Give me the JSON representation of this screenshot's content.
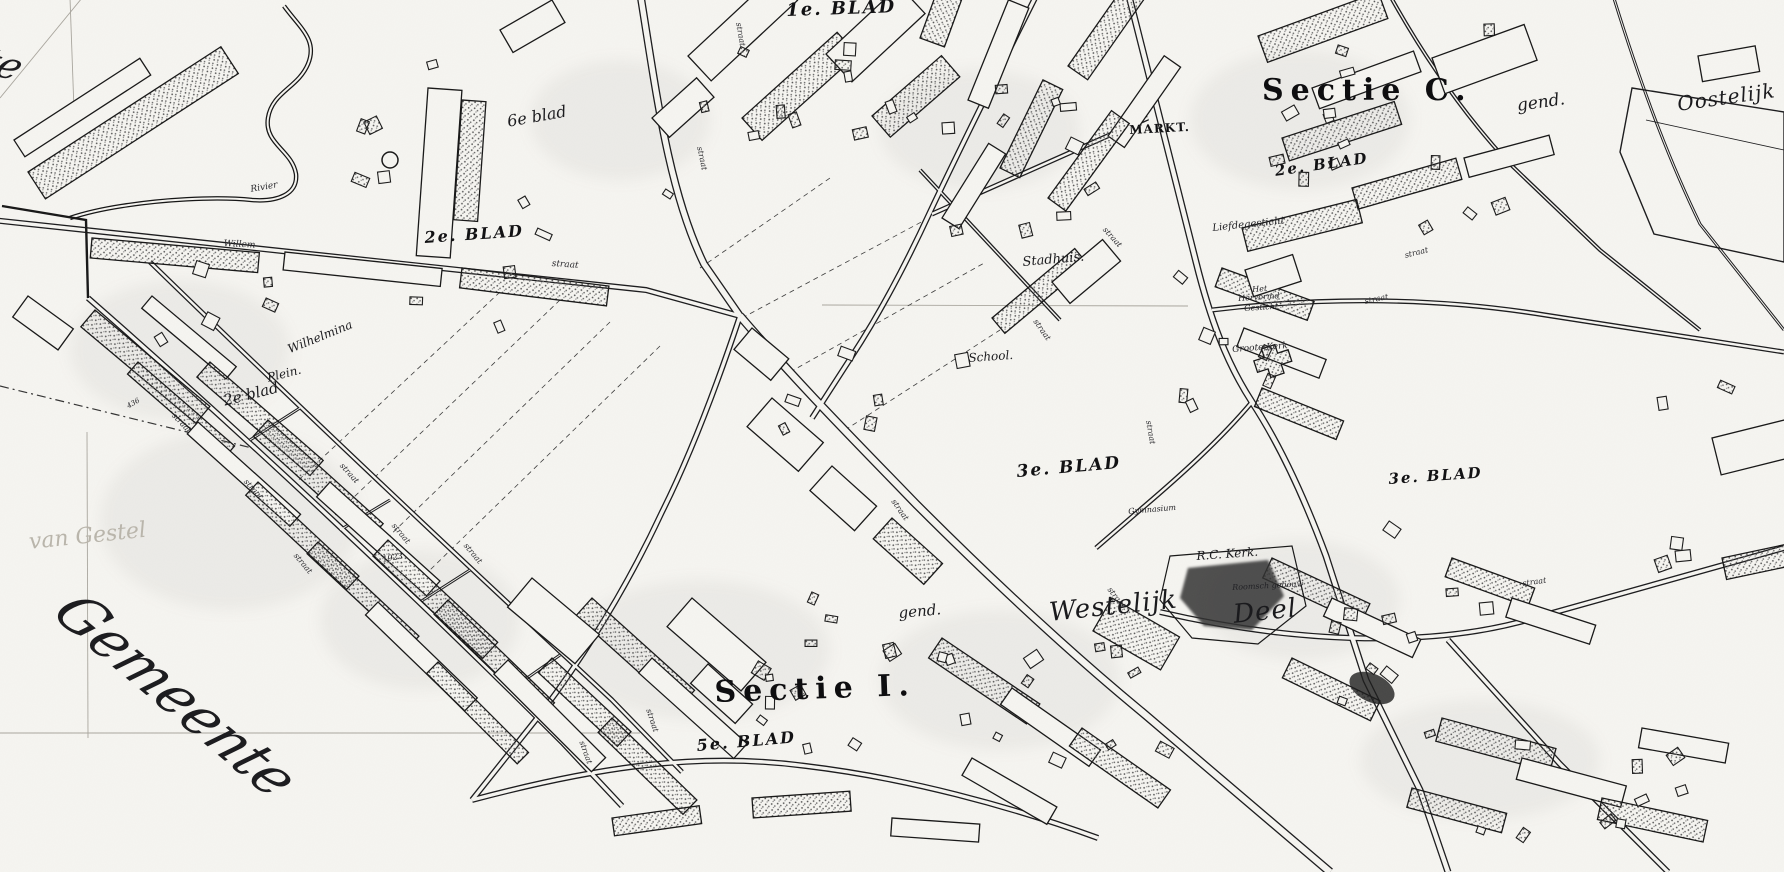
{
  "map": {
    "name": "historic-cadastral-town-map",
    "colors": {
      "ink": "#1a1a1c",
      "paper": "#f6f5f1",
      "smudge": "#777777",
      "faint_line": "#a9a69e"
    },
    "labels": [
      {
        "id": "sheet-1-blad",
        "text": "1e. BLAD",
        "x": 786,
        "y": 2,
        "rot": -2,
        "size": 18,
        "cls": "bold"
      },
      {
        "id": "sheet-6-blad-cursive",
        "text": "6e blad",
        "x": 506,
        "y": 114,
        "rot": -10,
        "size": 16,
        "cls": "cursive"
      },
      {
        "id": "sheet-2-blad-left",
        "text": "2e. BLAD",
        "x": 424,
        "y": 230,
        "rot": -4,
        "size": 16,
        "cls": "bold"
      },
      {
        "id": "section-c-title",
        "text": "Sectie C.",
        "x": 1262,
        "y": 76,
        "rot": 0,
        "size": 30,
        "cls": "sectie"
      },
      {
        "id": "markt-label",
        "text": "MARKT.",
        "x": 1129,
        "y": 124,
        "rot": -3,
        "size": 12,
        "cls": "smallcaps"
      },
      {
        "id": "sheet-2-blad-right",
        "text": "2e. BLAD",
        "x": 1274,
        "y": 164,
        "rot": -8,
        "size": 15,
        "cls": "bold"
      },
      {
        "id": "gend-top",
        "text": "gend.",
        "x": 1516,
        "y": 98,
        "rot": -8,
        "size": 17,
        "cls": "cursive"
      },
      {
        "id": "oostelijk-label",
        "text": "Oostelijk",
        "x": 1676,
        "y": 94,
        "rot": -8,
        "size": 20,
        "cls": "bigcursive"
      },
      {
        "id": "liefdegesticht-label",
        "text": "Liefdegesticht",
        "x": 1212,
        "y": 224,
        "rot": -6,
        "size": 10,
        "cls": "tiny"
      },
      {
        "id": "stadhuis-label",
        "text": "Stadhuis.",
        "x": 1022,
        "y": 256,
        "rot": -5,
        "size": 13,
        "cls": "cursive"
      },
      {
        "id": "het-label",
        "text": "Het",
        "x": 1252,
        "y": 286,
        "rot": -4,
        "size": 8,
        "cls": "tiny"
      },
      {
        "id": "hervormd-label",
        "text": "Hervormd",
        "x": 1238,
        "y": 295,
        "rot": -4,
        "size": 8,
        "cls": "tiny"
      },
      {
        "id": "gesticht-label",
        "text": "Gesticht",
        "x": 1244,
        "y": 305,
        "rot": -4,
        "size": 8,
        "cls": "tiny"
      },
      {
        "id": "school-label",
        "text": "School.",
        "x": 968,
        "y": 352,
        "rot": -4,
        "size": 12,
        "cls": "cursive"
      },
      {
        "id": "groote-kerk-label",
        "text": "Groote Kerk",
        "x": 1232,
        "y": 346,
        "rot": -4,
        "size": 9,
        "cls": "tiny"
      },
      {
        "id": "sheet-3-blad-center",
        "text": "3e. BLAD",
        "x": 1016,
        "y": 464,
        "rot": -5,
        "size": 17,
        "cls": "bold"
      },
      {
        "id": "gymnasium-label",
        "text": "Gymnasium",
        "x": 1128,
        "y": 508,
        "rot": -5,
        "size": 8,
        "cls": "tiny"
      },
      {
        "id": "sheet-3-blad-right",
        "text": "3e. BLAD",
        "x": 1388,
        "y": 472,
        "rot": -4,
        "size": 15,
        "cls": "bold"
      },
      {
        "id": "rc-kerk-label",
        "text": "R.C. Kerk.",
        "x": 1196,
        "y": 550,
        "rot": -4,
        "size": 12,
        "cls": "cursive"
      },
      {
        "id": "roomsch-gebouw-label",
        "text": "Roomsch gebouw",
        "x": 1232,
        "y": 584,
        "rot": -3,
        "size": 8,
        "cls": "tiny"
      },
      {
        "id": "gend-bottom",
        "text": "gend.",
        "x": 898,
        "y": 606,
        "rot": -5,
        "size": 15,
        "cls": "cursive"
      },
      {
        "id": "westelijk-label",
        "text": "Westelijk",
        "x": 1048,
        "y": 600,
        "rot": -6,
        "size": 26,
        "cls": "bigcursive"
      },
      {
        "id": "deel-label",
        "text": "Deel",
        "x": 1232,
        "y": 602,
        "rot": -6,
        "size": 26,
        "cls": "bigcursive"
      },
      {
        "id": "section-i-title",
        "text": "Sectie I.",
        "x": 714,
        "y": 678,
        "rot": -2,
        "size": 30,
        "cls": "sectie"
      },
      {
        "id": "sheet-5-blad",
        "text": "5e. BLAD",
        "x": 696,
        "y": 738,
        "rot": -5,
        "size": 16,
        "cls": "bold"
      },
      {
        "id": "wilhelmina-label",
        "text": "Wilhelmina",
        "x": 286,
        "y": 344,
        "rot": -22,
        "size": 12,
        "cls": "cursive"
      },
      {
        "id": "plein-label",
        "text": "Plein.",
        "x": 266,
        "y": 372,
        "rot": -14,
        "size": 12,
        "cls": "cursive"
      },
      {
        "id": "sheet-2-blad-cursive",
        "text": "2e blad",
        "x": 222,
        "y": 394,
        "rot": -14,
        "size": 15,
        "cls": "cursive"
      },
      {
        "id": "willem-street-label",
        "text": "Willem",
        "x": 224,
        "y": 240,
        "rot": 3,
        "size": 9,
        "cls": "street"
      },
      {
        "id": "straat-willem-label",
        "text": "straat",
        "x": 552,
        "y": 260,
        "rot": 4,
        "size": 9,
        "cls": "street"
      },
      {
        "id": "rivier-label",
        "text": "Rivier",
        "x": 250,
        "y": 186,
        "rot": -10,
        "size": 9,
        "cls": "street"
      },
      {
        "id": "gestel-handwriting",
        "text": "van Gestel",
        "x": 28,
        "y": 532,
        "rot": -6,
        "size": 22,
        "cls": "faint"
      },
      {
        "id": "gemeente-script",
        "text": "Gemeente",
        "x": 88,
        "y": 586,
        "rot": 40,
        "size": 56,
        "cls": "gemeente",
        "skew": -14
      },
      {
        "id": "edge-script-te",
        "text": "te",
        "x": -6,
        "y": 42,
        "rot": 15,
        "size": 38,
        "cls": "gemeente",
        "skew": -14
      },
      {
        "id": "parcel-number-436",
        "text": "436",
        "x": 126,
        "y": 404,
        "rot": -30,
        "size": 7,
        "cls": "tiny"
      },
      {
        "id": "parcel-number-1923",
        "text": "1923",
        "x": 382,
        "y": 556,
        "rot": -10,
        "size": 8,
        "cls": "tiny"
      },
      {
        "id": "street-label-1",
        "text": "straat",
        "x": 742,
        "y": 22,
        "rot": 80,
        "size": 8,
        "cls": "street"
      },
      {
        "id": "street-label-2",
        "text": "straat",
        "x": 703,
        "y": 146,
        "rot": 78,
        "size": 8,
        "cls": "street"
      },
      {
        "id": "street-label-3",
        "text": "straat",
        "x": 1107,
        "y": 226,
        "rot": 48,
        "size": 8,
        "cls": "street"
      },
      {
        "id": "street-label-4",
        "text": "straat",
        "x": 1038,
        "y": 318,
        "rot": 55,
        "size": 8,
        "cls": "street"
      },
      {
        "id": "street-label-5",
        "text": "straat",
        "x": 1152,
        "y": 420,
        "rot": 80,
        "size": 8,
        "cls": "street"
      },
      {
        "id": "street-label-6",
        "text": "straat",
        "x": 1364,
        "y": 298,
        "rot": -12,
        "size": 8,
        "cls": "street"
      },
      {
        "id": "street-label-7",
        "text": "straat",
        "x": 1404,
        "y": 252,
        "rot": -14,
        "size": 8,
        "cls": "street"
      },
      {
        "id": "street-label-8",
        "text": "straat",
        "x": 896,
        "y": 498,
        "rot": 55,
        "size": 8,
        "cls": "street"
      },
      {
        "id": "street-label-9",
        "text": "straat",
        "x": 652,
        "y": 708,
        "rot": 72,
        "size": 8,
        "cls": "street"
      },
      {
        "id": "street-label-10",
        "text": "straat",
        "x": 585,
        "y": 740,
        "rot": 70,
        "size": 8,
        "cls": "street"
      },
      {
        "id": "street-label-11",
        "text": "straat",
        "x": 1112,
        "y": 586,
        "rot": 52,
        "size": 8,
        "cls": "street"
      },
      {
        "id": "street-label-12",
        "text": "straat",
        "x": 1522,
        "y": 580,
        "rot": -8,
        "size": 8,
        "cls": "street"
      },
      {
        "id": "street-label-13",
        "text": "straat",
        "x": 248,
        "y": 478,
        "rot": 48,
        "size": 8,
        "cls": "street"
      },
      {
        "id": "street-label-14",
        "text": "straat",
        "x": 344,
        "y": 462,
        "rot": 48,
        "size": 8,
        "cls": "street"
      },
      {
        "id": "street-label-15",
        "text": "straat",
        "x": 298,
        "y": 552,
        "rot": 50,
        "size": 8,
        "cls": "street"
      },
      {
        "id": "street-label-16",
        "text": "straat",
        "x": 176,
        "y": 412,
        "rot": 46,
        "size": 8,
        "cls": "street"
      },
      {
        "id": "street-label-17",
        "text": "straat",
        "x": 468,
        "y": 542,
        "rot": 50,
        "size": 8,
        "cls": "street"
      },
      {
        "id": "street-label-18",
        "text": "straat",
        "x": 396,
        "y": 522,
        "rot": 50,
        "size": 8,
        "cls": "street"
      }
    ]
  }
}
